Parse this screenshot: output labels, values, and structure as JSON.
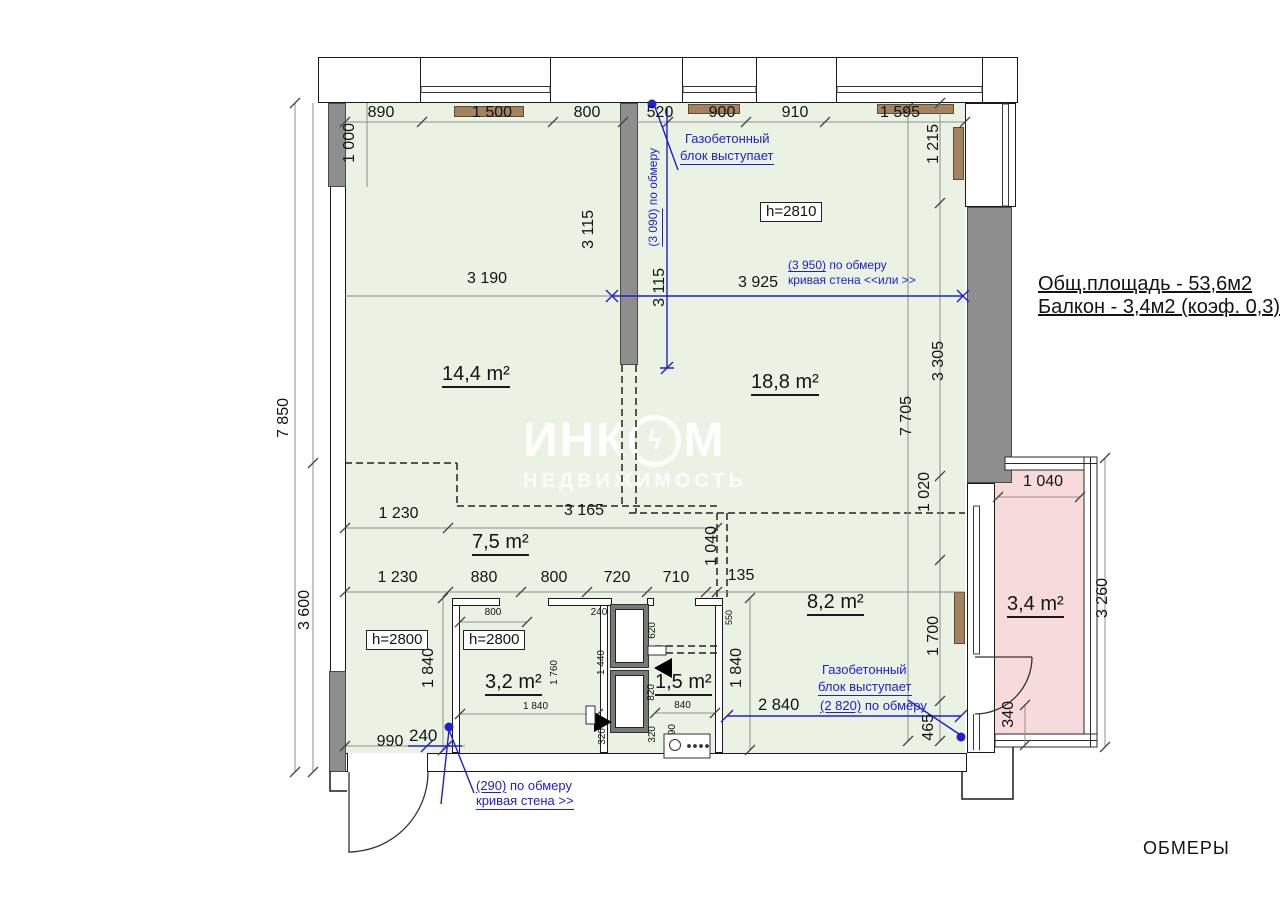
{
  "plan": {
    "sheet_label": "ОБМЕРЫ",
    "summary": {
      "total": "Общ.площадь - 53,6м2",
      "balcony": "Балкон - 3,4м2 (коэф. 0,3)"
    },
    "watermark": {
      "pre": "ИНК",
      "post": "М",
      "bolt": "ϟ",
      "sub": "НЕДВИЖИМОСТЬ"
    },
    "rooms": {
      "living1": "14,4 m²",
      "living2": "18,8 m²",
      "hall": "7,5 m²",
      "kitchen": "8,2 m²",
      "bath": "3,2 m²",
      "wc": "1,5 m²",
      "balcony": "3,4 m²"
    },
    "ceiling_heights": {
      "room2": "h=2810",
      "hall": "h=2800",
      "bath": "h=2800"
    },
    "dims": {
      "top": [
        "890",
        "1 500",
        "800",
        "520",
        "900",
        "910",
        "1 595"
      ],
      "left": {
        "h1000": "1 000",
        "h7850": "7 850",
        "h3600": "3 600"
      },
      "right": {
        "h1215": "1 215",
        "h3305": "3 305",
        "h7705": "7 705",
        "h1020": "1 020",
        "h1700": "1 700",
        "h465": "465"
      },
      "middle": {
        "w3190": "3 190",
        "h3115a": "3 115",
        "h3115b": "3 115",
        "w3925": "3 925"
      },
      "hall_row1": [
        "1 230",
        "3 165"
      ],
      "hall_row2": [
        "1 230",
        "880",
        "800",
        "720",
        "710",
        "135"
      ],
      "inner": {
        "h1040": "1 040",
        "h1840a": "1 840",
        "h1840b": "1 840",
        "h550": "550"
      },
      "bath": {
        "w800": "800",
        "w240": "240",
        "h620": "620",
        "h1440": "1 440",
        "h1760": "1 760",
        "w1840": "1 840",
        "h820": "820",
        "w840": "840",
        "h320a": "320",
        "h320b": "320",
        "h90": "90"
      },
      "entry": {
        "w990": "990",
        "w240": "240"
      },
      "kitchen": {
        "w2840": "2 840"
      },
      "balcony": {
        "w1040": "1 040",
        "h3260": "3 260",
        "h340": "340"
      }
    },
    "notes": {
      "gas_top": {
        "l1": "Газобетонный",
        "l2": "блок выступает"
      },
      "gas_bottom": {
        "l1": "Газобетонный",
        "l2": "блок выступает"
      },
      "obmer_3090": {
        "m": "(3 090)",
        "rest": " по обмеру"
      },
      "curve_right": {
        "m": "(3 950)",
        "rest": " по обмеру",
        "l2": "кривая стена <<или >>"
      },
      "obmer_2820": {
        "m": "(2 820)",
        "rest": " по обмеру"
      },
      "curve_entry": {
        "m": "(290)",
        "rest": " по обмеру",
        "l2": "кривая стена >>"
      }
    }
  }
}
